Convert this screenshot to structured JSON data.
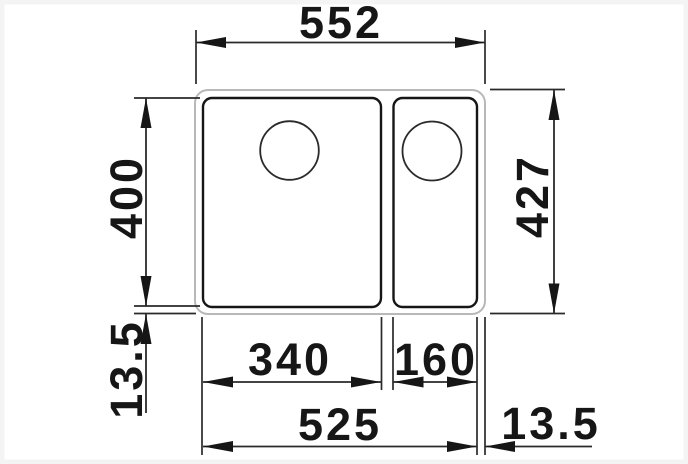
{
  "drawing": {
    "kind": "sink-dimension-drawing",
    "colors": {
      "line": "#161616",
      "rim_outline": "#b8b8b8",
      "background": "#ffffff"
    }
  },
  "labels": {
    "top_width": "552",
    "left_depth": "400",
    "left_rim": "13.5",
    "right_depth": "427",
    "main_bowl": "340",
    "small_bowl": "160",
    "bottom_span": "525",
    "bottom_right_rim": "13.5"
  }
}
